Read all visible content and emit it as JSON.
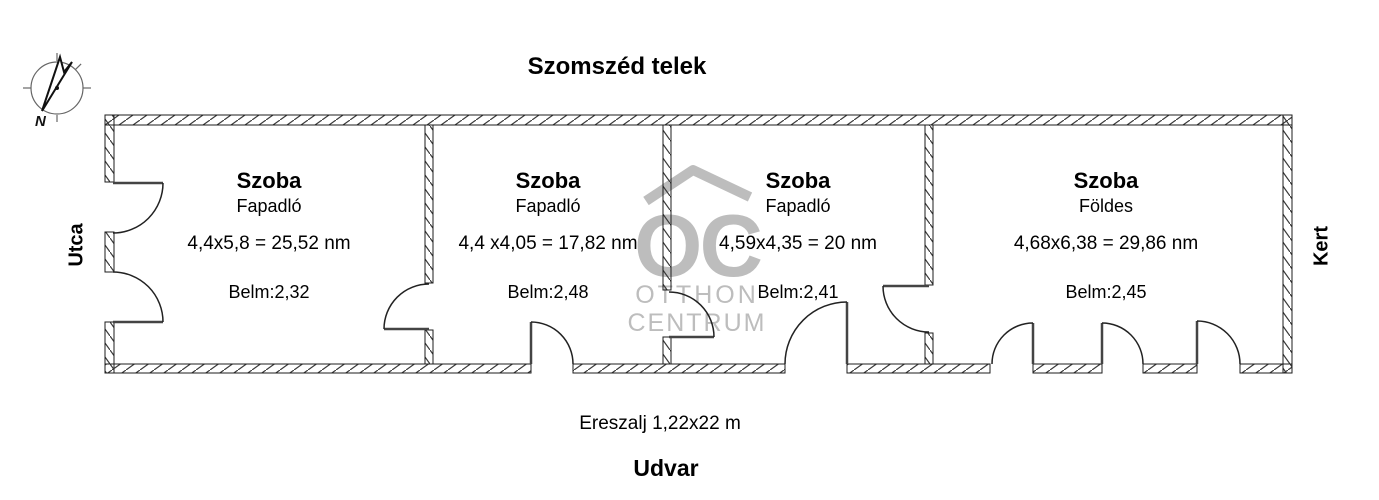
{
  "plan": {
    "title_top": "Szomszéd telek",
    "label_left": "Utca",
    "label_right": "Kert",
    "label_eaves": "Ereszalj 1,22x22 m",
    "label_bottom": "Udvar",
    "compass_north": "N"
  },
  "watermark": {
    "logo": "OC",
    "name_line1": "OTTHON",
    "name_line2": "CENTRUM"
  },
  "rooms": [
    {
      "name": "Szoba",
      "floor": "Fapadló",
      "dimensions": "4,4x5,8 = 25,52 nm",
      "ceiling": "Belm:2,32"
    },
    {
      "name": "Szoba",
      "floor": "Fapadló",
      "dimensions": "4,4 x4,05 = 17,82 nm",
      "ceiling": "Belm:2,48"
    },
    {
      "name": "Szoba",
      "floor": "Fapadló",
      "dimensions": "4,59x4,35 = 20 nm",
      "ceiling": "Belm:2,41"
    },
    {
      "name": "Szoba",
      "floor": "Földes",
      "dimensions": "4,68x6,38 = 29,86 nm",
      "ceiling": "Belm:2,45"
    }
  ],
  "colors": {
    "wall_line": "#1c1c1c",
    "door_line": "#222222",
    "watermark": "#bdbdbd",
    "text": "#000000",
    "background": "#ffffff"
  }
}
